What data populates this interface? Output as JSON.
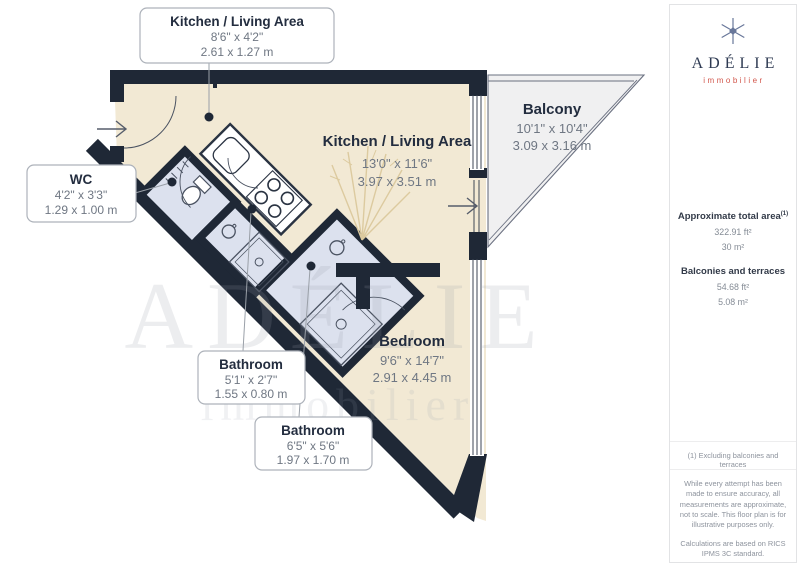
{
  "plan": {
    "boxes": {
      "kitchen_area": {
        "title": "Kitchen / Living Area",
        "imperial": "8'6\" x 4'2\"",
        "metric": "2.61 x 1.27 m"
      },
      "wc": {
        "title": "WC",
        "imperial": "4'2\" x 3'3\"",
        "metric": "1.29 x 1.00 m"
      },
      "bathroom_small": {
        "title": "Bathroom",
        "imperial": "5'1\" x 2'7\"",
        "metric": "1.55 x 0.80 m"
      },
      "bathroom_large": {
        "title": "Bathroom",
        "imperial": "6'5\" x 5'6\"",
        "metric": "1.97 x 1.70 m"
      }
    },
    "rooms": {
      "kitchen": {
        "title": "Kitchen / Living Area",
        "imperial": "13'0\" x 11'6\"",
        "metric": "3.97 x 3.51 m"
      },
      "balcony": {
        "title": "Balcony",
        "imperial": "10'1\" x 10'4\"",
        "metric": "3.09 x 3.16 m"
      },
      "bedroom": {
        "title": "Bedroom",
        "imperial": "9'6\" x 14'7\"",
        "metric": "2.91 x 4.45 m"
      }
    },
    "watermark_line1": "ADÉLIE",
    "watermark_line2": "immobilier",
    "colors": {
      "wall": "#1f2836",
      "living_floor": "#f2e9d4",
      "wet_room_floor": "#dce1ee",
      "balcony_floor": "#f0f0f1"
    }
  },
  "sidebar": {
    "brand": {
      "name": "ADÉLIE",
      "tagline": "immobilier",
      "accent": "#d2564b",
      "navy": "#2e3a52"
    },
    "areas": {
      "total_label": "Approximate total area",
      "total_sup": "(1)",
      "total_imperial": "322.91 ft²",
      "total_metric": "30 m²",
      "balconies_label": "Balconies and terraces",
      "balconies_imperial": "54.68 ft²",
      "balconies_metric": "5.08 m²"
    },
    "footnote": "(1) Excluding balconies and terraces",
    "disclaimer_1": "While every attempt has been made to ensure accuracy, all measurements are approximate, not to scale. This floor plan is for illustrative purposes only.",
    "disclaimer_2": "Calculations are based on RICS IPMS 3C standard.",
    "credit_name": "GIRAFFE",
    "credit_suffix": "360"
  }
}
